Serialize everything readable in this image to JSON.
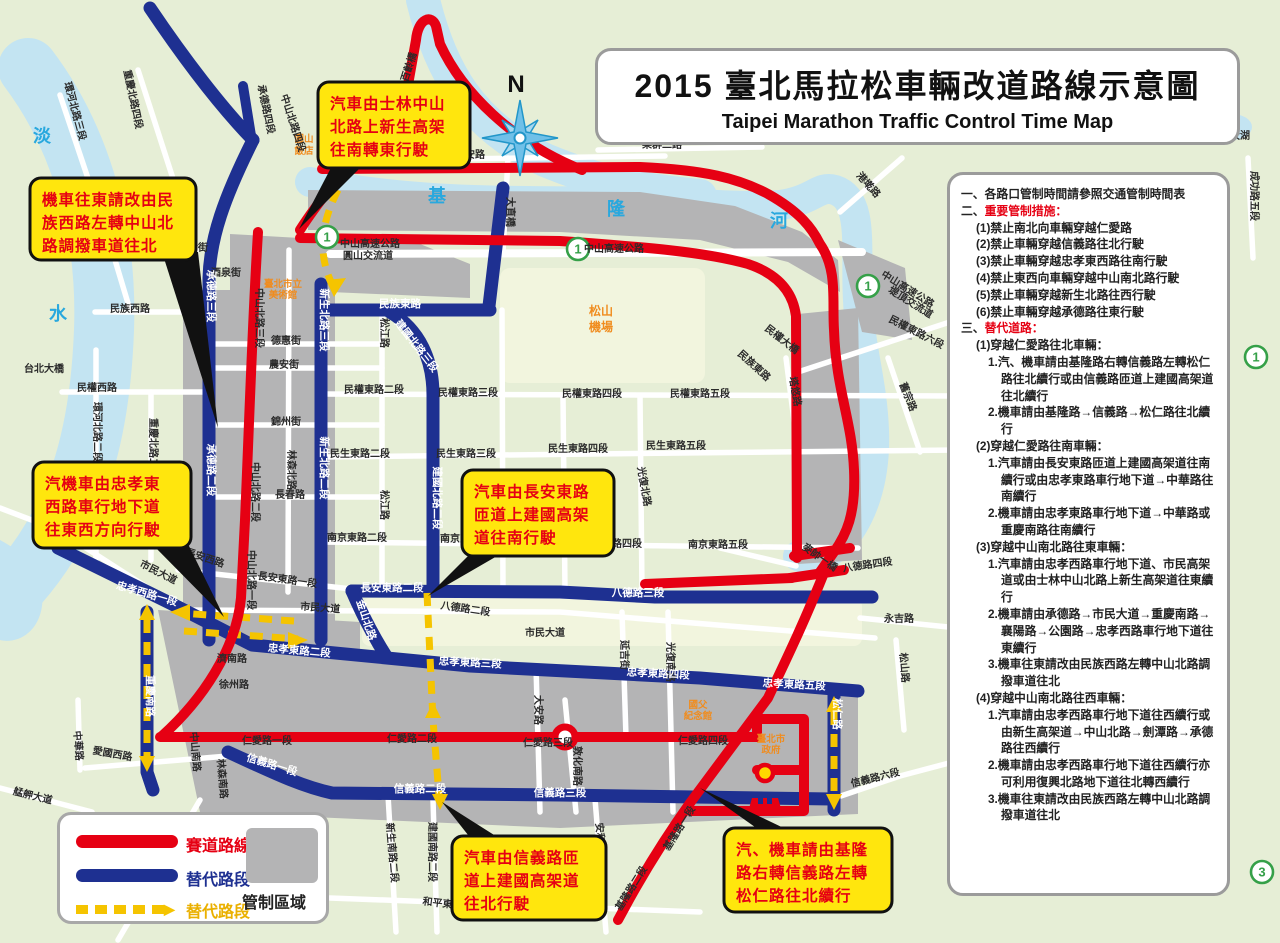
{
  "title": {
    "zh": "2015 臺北馬拉松車輛改道路線示意圖",
    "en": "Taipei Marathon Traffic Control Time Map"
  },
  "compass_label": "N",
  "legend": {
    "course": "賽道路線",
    "alt_road": "替代路段",
    "alt_road2": "替代路段",
    "control_zone": "管制區域"
  },
  "panel": {
    "lines": [
      {
        "c": "l0",
        "parts": [
          {
            "t": "一、各路口管制時間請參照交通管制時間表",
            "s": "b"
          }
        ]
      },
      {
        "c": "l0",
        "parts": [
          {
            "t": "二、",
            "s": "b"
          },
          {
            "t": "重要管制措施：",
            "s": "red"
          }
        ]
      },
      {
        "c": "l1",
        "parts": [
          {
            "t": "(1)禁止南北向車輛穿越仁愛路"
          }
        ]
      },
      {
        "c": "l1",
        "parts": [
          {
            "t": "(2)禁止車輛穿越信義路往北行駛"
          }
        ]
      },
      {
        "c": "l1",
        "parts": [
          {
            "t": "(3)禁止車輛穿越忠孝東西路往南行駛"
          }
        ]
      },
      {
        "c": "l1",
        "parts": [
          {
            "t": "(4)禁止東西向車輛穿越中山南北路行駛"
          }
        ]
      },
      {
        "c": "l1",
        "parts": [
          {
            "t": "(5)禁止車輛穿越新生北路往西行駛"
          }
        ]
      },
      {
        "c": "l1",
        "parts": [
          {
            "t": "(6)禁止車輛穿越承德路往東行駛"
          }
        ]
      },
      {
        "c": "l0",
        "parts": [
          {
            "t": "三、",
            "s": "b"
          },
          {
            "t": "替代道路：",
            "s": "red"
          }
        ]
      },
      {
        "c": "h2",
        "parts": [
          {
            "t": "(1)"
          },
          {
            "t": "穿越仁愛路往北車輛：",
            "s": "b"
          }
        ]
      },
      {
        "c": "l2",
        "parts": [
          {
            "t": "1.汽、機車請由基隆路右轉信義路左轉松仁路往北續行或由信義路匝道上建國高架道往北續行"
          }
        ]
      },
      {
        "c": "l2",
        "parts": [
          {
            "t": "2.機車請由基隆路→信義路→松仁路往北續行"
          }
        ]
      },
      {
        "c": "h2",
        "parts": [
          {
            "t": "(2)"
          },
          {
            "t": "穿越仁愛路往南車輛：",
            "s": "b"
          }
        ]
      },
      {
        "c": "l2",
        "parts": [
          {
            "t": "1.汽車請由長安東路匝道上建國高架道往南續行或由忠孝東路車行地下道→中華路往南續行"
          }
        ]
      },
      {
        "c": "l2",
        "parts": [
          {
            "t": "2.機車請由忠孝東路車行地下道→中華路或重慶南路往南續行"
          }
        ]
      },
      {
        "c": "h2",
        "parts": [
          {
            "t": "(3)"
          },
          {
            "t": "穿越中山南北路往東車輛：",
            "s": "b"
          }
        ]
      },
      {
        "c": "l2",
        "parts": [
          {
            "t": "1.汽車請由忠孝西路車行地下道、市民高架道或由士林中山北路上新生高架道往東續行"
          }
        ]
      },
      {
        "c": "l2",
        "parts": [
          {
            "t": "2.機車請由承德路→市民大道→重慶南路→襄陽路→公園路→忠孝西路車行地下道往東續行"
          }
        ]
      },
      {
        "c": "l2",
        "parts": [
          {
            "t": "3.機車往東請改由民族西路左轉中山北路調撥車道往北"
          }
        ]
      },
      {
        "c": "h2",
        "parts": [
          {
            "t": "(4)"
          },
          {
            "t": "穿越中山南北路往西車輛：",
            "s": "b"
          }
        ]
      },
      {
        "c": "l2",
        "parts": [
          {
            "t": "1.汽車請由忠孝西路車行地下道往西續行或由新生高架道→中山北路→劍潭路→承德路往西續行"
          }
        ]
      },
      {
        "c": "l2",
        "parts": [
          {
            "t": "2.機車請由忠孝西路車行地下道往西續行亦可利用復興北路地下道往北轉西續行"
          }
        ]
      },
      {
        "c": "l2",
        "parts": [
          {
            "t": "3.機車往東請改由民族西路左轉中山北路調撥車道往北"
          }
        ]
      }
    ]
  },
  "callouts": [
    {
      "id": "c1",
      "lines": [
        "機車往東請改由民",
        "族西路左轉中山北",
        "路調撥車道往北"
      ],
      "box": [
        30,
        178,
        166,
        82
      ],
      "tail": "162,252 198,252 218,428"
    },
    {
      "id": "c2",
      "lines": [
        "汽車由士林中山",
        "北路上新生高架",
        "往南轉東行駛"
      ],
      "box": [
        318,
        82,
        152,
        86
      ],
      "tail": "334,162 366,162 299,229"
    },
    {
      "id": "c3",
      "lines": [
        "汽機車由忠孝東",
        "西路車行地下道",
        "往東西方向行駛"
      ],
      "box": [
        33,
        462,
        158,
        86
      ],
      "tail": "152,544 188,544 224,617"
    },
    {
      "id": "c4",
      "lines": [
        "汽車由長安東路",
        "匝道上建國高架",
        "道往南行駛"
      ],
      "box": [
        462,
        470,
        152,
        86
      ],
      "tail": "472,552 504,552 428,596"
    },
    {
      "id": "c5",
      "lines": [
        "汽車由信義路匝",
        "道上建國高架道",
        "往北行駛"
      ],
      "box": [
        452,
        836,
        154,
        84
      ],
      "tail": "472,840 502,840 442,802"
    },
    {
      "id": "c6",
      "lines": [
        "汽、機車請由基隆",
        "路右轉信義路左轉",
        "松仁路往北續行"
      ],
      "box": [
        724,
        828,
        168,
        84
      ],
      "tail": "762,832 792,832 700,788"
    }
  ],
  "map": {
    "shields": [
      {
        "n": "1",
        "x": 327,
        "y": 237
      },
      {
        "n": "1",
        "x": 578,
        "y": 249
      },
      {
        "n": "1",
        "x": 868,
        "y": 286
      },
      {
        "n": "1",
        "x": 1256,
        "y": 357
      },
      {
        "n": "3",
        "x": 1262,
        "y": 872
      }
    ],
    "labels": [
      [
        "淡",
        42,
        142,
        0,
        "rv"
      ],
      [
        "水",
        58,
        320,
        0,
        "rv"
      ],
      [
        "基",
        437,
        202,
        0,
        "rv"
      ],
      [
        "隆",
        616,
        215,
        0,
        "rv"
      ],
      [
        "河",
        779,
        227,
        0,
        "rv"
      ],
      [
        "圓山",
        304,
        142,
        0,
        "or2"
      ],
      [
        "飯店",
        304,
        154,
        0,
        "or2"
      ],
      [
        "忠烈祠",
        392,
        162,
        0,
        "or"
      ],
      [
        "臺北市立",
        283,
        287,
        0,
        "or2"
      ],
      [
        "美術館",
        283,
        298,
        0,
        "or2"
      ],
      [
        "松山",
        601,
        315,
        0,
        "or"
      ],
      [
        "機場",
        601,
        331,
        0,
        "or"
      ],
      [
        "國父",
        698,
        708,
        0,
        "or2"
      ],
      [
        "紀念館",
        698,
        719,
        0,
        "or2"
      ],
      [
        "臺北市",
        771,
        742,
        0,
        "or2"
      ],
      [
        "政府",
        771,
        753,
        0,
        "or2"
      ],
      [
        "中山高速公路",
        614,
        252,
        0,
        "rd9"
      ],
      [
        "中山高速公路",
        370,
        247,
        0,
        "rd9"
      ],
      [
        "圓山交流道",
        368,
        259,
        0,
        "rd9"
      ],
      [
        "中山高速公路",
        906,
        292,
        32,
        "rd9"
      ],
      [
        "堤頂交流道",
        909,
        305,
        32,
        "rd9"
      ],
      [
        "北安路",
        470,
        158,
        0,
        "rd9"
      ],
      [
        "樂群二路",
        662,
        148,
        0,
        "rd9"
      ],
      [
        "港墘路",
        866,
        187,
        48,
        "rd9"
      ],
      [
        "大直橋",
        507,
        212,
        90,
        "rd9"
      ],
      [
        "百齡橋",
        412,
        68,
        -72,
        "rd9"
      ],
      [
        "台北大橋",
        44,
        372,
        0,
        "rd9"
      ],
      [
        "環河北路三段",
        72,
        112,
        75,
        "rd9"
      ],
      [
        "重慶北路四段",
        130,
        100,
        78,
        "rd9"
      ],
      [
        "承德路四段",
        263,
        110,
        78,
        "rd9"
      ],
      [
        "中山北路四段",
        290,
        124,
        72,
        "rd9"
      ],
      [
        "庫倫街",
        193,
        251,
        0,
        "rd9"
      ],
      [
        "酒泉街",
        226,
        276,
        0,
        "rd9"
      ],
      [
        "民族西路",
        130,
        312,
        0,
        "rd9"
      ],
      [
        "民權西路",
        97,
        391,
        0,
        "rd9"
      ],
      [
        "環河北路二段",
        94,
        432,
        90,
        "rd9"
      ],
      [
        "重慶北路二段",
        150,
        448,
        90,
        "rd9"
      ],
      [
        "中山北路三段",
        256,
        318,
        90,
        "rd9"
      ],
      [
        "中山北路二段",
        252,
        492,
        90,
        "rd9"
      ],
      [
        "中山北路一段",
        248,
        580,
        90,
        "rd9"
      ],
      [
        "德惠街",
        286,
        344,
        0,
        "rd9"
      ],
      [
        "農安街",
        284,
        368,
        0,
        "rd9"
      ],
      [
        "錦州街",
        286,
        425,
        0,
        "rd9"
      ],
      [
        "長春路",
        290,
        498,
        0,
        "rd9"
      ],
      [
        "林森北路",
        288,
        470,
        90,
        "rd9"
      ],
      [
        "松江路",
        381,
        333,
        90,
        "rd9"
      ],
      [
        "松江路",
        381,
        505,
        90,
        "rd9"
      ],
      [
        "民權東路二段",
        374,
        393,
        0,
        "rd9"
      ],
      [
        "民權東路三段",
        468,
        396,
        0,
        "rd9"
      ],
      [
        "民權東路四段",
        592,
        397,
        0,
        "rd9"
      ],
      [
        "民權東路五段",
        700,
        397,
        0,
        "rd9"
      ],
      [
        "民權東路六段",
        915,
        335,
        27,
        "rd9"
      ],
      [
        "民生東路二段",
        360,
        457,
        0,
        "rd9"
      ],
      [
        "民生東路三段",
        466,
        457,
        0,
        "rd9"
      ],
      [
        "民生東路四段",
        578,
        452,
        0,
        "rd9"
      ],
      [
        "民生東路五段",
        676,
        449,
        0,
        "rd9"
      ],
      [
        "光復北路",
        641,
        487,
        80,
        "rd9"
      ],
      [
        "塔悠路",
        792,
        392,
        80,
        "rd9"
      ],
      [
        "舊宗路",
        905,
        398,
        68,
        "rd9"
      ],
      [
        "民族東路",
        752,
        368,
        42,
        "rd9"
      ],
      [
        "民權大橋",
        780,
        342,
        38,
        "rd9"
      ],
      [
        "麥帥一橋",
        818,
        560,
        35,
        "rd9"
      ],
      [
        "八德路四段",
        868,
        568,
        -8,
        "rd9"
      ],
      [
        "南京東路二段",
        357,
        541,
        0,
        "rd9"
      ],
      [
        "南京東路三段",
        470,
        542,
        0,
        "rd9"
      ],
      [
        "南京東路四段",
        612,
        547,
        0,
        "rd9"
      ],
      [
        "南京東路五段",
        718,
        548,
        0,
        "rd9"
      ],
      [
        "長安西路",
        204,
        561,
        18,
        "rd9"
      ],
      [
        "長安東路一段",
        287,
        583,
        8,
        "rd9"
      ],
      [
        "八德路二段",
        465,
        612,
        8,
        "rd9"
      ],
      [
        "市民大道",
        157,
        575,
        27,
        "rd9"
      ],
      [
        "市民大道",
        320,
        611,
        4,
        "rd9"
      ],
      [
        "市民大道",
        545,
        636,
        0,
        "rd9"
      ],
      [
        "延吉街",
        621,
        655,
        90,
        "rd9"
      ],
      [
        "光復南路",
        667,
        662,
        90,
        "rd9"
      ],
      [
        "濟南路",
        232,
        662,
        0,
        "rd9"
      ],
      [
        "徐州路",
        234,
        688,
        0,
        "rd9"
      ],
      [
        "仁愛路一段",
        267,
        744,
        0,
        "rd9"
      ],
      [
        "仁愛路二段",
        412,
        742,
        0,
        "rd9"
      ],
      [
        "仁愛路三段",
        548,
        746,
        0,
        "rd9"
      ],
      [
        "仁愛路四段",
        703,
        744,
        0,
        "rd9"
      ],
      [
        "敦化南路",
        574,
        766,
        90,
        "rd9"
      ],
      [
        "大安路",
        535,
        710,
        90,
        "rd9"
      ],
      [
        "中山南路",
        192,
        752,
        85,
        "rd9"
      ],
      [
        "林森南路",
        219,
        779,
        85,
        "rd9"
      ],
      [
        "中華路",
        75,
        746,
        85,
        "rd9"
      ],
      [
        "愛國西路",
        112,
        757,
        10,
        "rd9"
      ],
      [
        "艋舺大道",
        32,
        799,
        14,
        "rd9"
      ],
      [
        "新生南路二段",
        389,
        853,
        85,
        "rd9"
      ],
      [
        "建國南路二段",
        429,
        852,
        90,
        "rd9"
      ],
      [
        "安和路",
        597,
        838,
        85,
        "rd9"
      ],
      [
        "和平東路二段",
        452,
        908,
        7,
        "rd9"
      ],
      [
        "基隆路一段",
        682,
        830,
        -58,
        "rd9"
      ],
      [
        "基隆路二段",
        634,
        890,
        -58,
        "rd9"
      ],
      [
        "信義路六段",
        876,
        781,
        -14,
        "rd9"
      ],
      [
        "松山路",
        901,
        668,
        85,
        "rd9"
      ],
      [
        "永吉路",
        899,
        622,
        0,
        "rd9"
      ],
      [
        "成功路五段",
        1251,
        196,
        90,
        "rd9"
      ],
      [
        "大湖",
        1240,
        139,
        0,
        "rd9"
      ],
      [
        "承德路三段",
        208,
        296,
        90,
        "wt"
      ],
      [
        "承德路二段",
        208,
        470,
        90,
        "wt"
      ],
      [
        "新生北路三段",
        321,
        320,
        90,
        "wt"
      ],
      [
        "新生北路二段",
        321,
        468,
        90,
        "wt"
      ],
      [
        "建國北路三段",
        414,
        348,
        52,
        "wt"
      ],
      [
        "建國北路二段",
        434,
        498,
        90,
        "wt"
      ],
      [
        "民族東路",
        400,
        307,
        0,
        "wt"
      ],
      [
        "長安東路二段",
        392,
        591,
        0,
        "wt"
      ],
      [
        "八德路三段",
        638,
        596,
        0,
        "wt"
      ],
      [
        "金山北路",
        363,
        621,
        72,
        "wt"
      ],
      [
        "忠孝西路一段",
        146,
        597,
        16,
        "wt"
      ],
      [
        "忠孝東路二段",
        299,
        654,
        5,
        "wt"
      ],
      [
        "忠孝東路三段",
        470,
        666,
        3,
        "wt"
      ],
      [
        "忠孝東路四段",
        658,
        677,
        3,
        "wt"
      ],
      [
        "忠孝東路五段",
        794,
        688,
        3,
        "wt"
      ],
      [
        "重慶南路",
        147,
        696,
        90,
        "wt"
      ],
      [
        "信義路一段",
        271,
        768,
        17,
        "wt"
      ],
      [
        "信義路二段",
        420,
        792,
        0,
        "wt"
      ],
      [
        "信義路三段",
        560,
        796,
        0,
        "wt"
      ],
      [
        "松仁路",
        834,
        714,
        90,
        "wt"
      ]
    ]
  }
}
